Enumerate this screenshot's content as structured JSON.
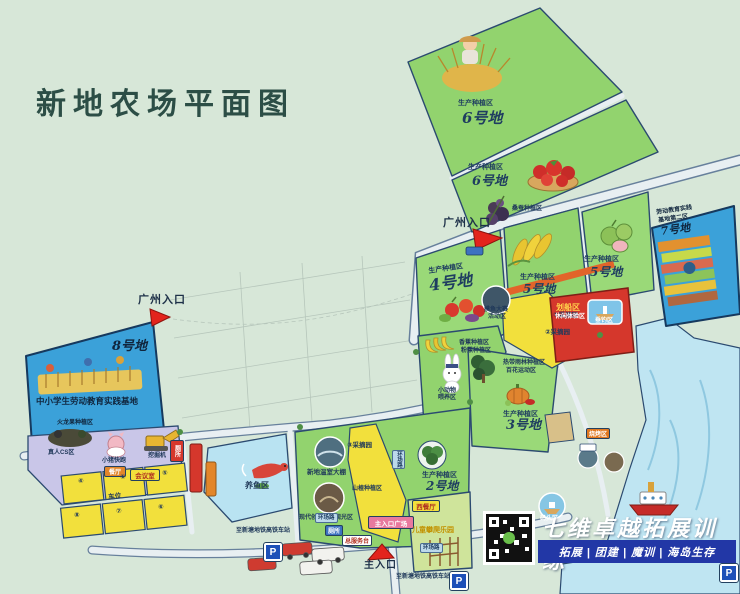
{
  "title": "新地农场平面图",
  "entrances": {
    "guangzhou_top": "广州入口",
    "guangzhou_left": "广州入口",
    "main": "主入口",
    "main_plaza": "主入口广场"
  },
  "plots": {
    "p6a": {
      "zone": "生产种植区",
      "num": "6号地"
    },
    "p6b": {
      "zone": "生产种植区",
      "num": "6号地"
    },
    "p5corn": {
      "zone": "生产种植区",
      "num": "5号地"
    },
    "p5guava": {
      "zone": "生产种植区",
      "num": "5号地"
    },
    "p4": {
      "zone": "生产种植区",
      "num": "4号地"
    },
    "p3": {
      "zone": "生产种植区",
      "num": "3号地"
    },
    "p2": {
      "zone": "生产种植区",
      "num": "2号地"
    },
    "p7": {
      "line1": "劳动教育实践",
      "line2": "基地第二区",
      "num": "7号地"
    },
    "p8": {
      "num": "8号地",
      "name": "中小学生劳动教育实践基地",
      "sub": "火龙果种植区"
    }
  },
  "areas": {
    "mulberry": "桑蚕种植区",
    "banana": "香蕉种植区",
    "banana2": "粉蕉种植区",
    "rabbit1": "小动物",
    "rabbit2": "喂养区",
    "rainforest": "热带雨林种植区",
    "flower": "百花运动区",
    "moyu1": "摸鱼大赛",
    "moyu2": "活动区",
    "boat": "划船区",
    "leisure": "休闲体验区",
    "fishing": "垂钓区",
    "pond": "养鱼区",
    "greenhouse": "新地温室大棚",
    "modern": "现代创意农业观光区",
    "picking1": "①采摘园",
    "picking2": "②采摘园",
    "picking3": "③采摘园",
    "hawthorn": "山楂种植区",
    "cs": "真人CS区",
    "pig": "小猪快跑",
    "digger": "挖掘机",
    "restaurant": "餐厅",
    "meeting": "会议室",
    "western": "西餐厅",
    "climb": "儿童攀爬乐园",
    "dock": "码头区",
    "bbq": "烧烤区"
  },
  "facilities": {
    "toilet": "厕所",
    "service": "总服务台",
    "ring_road": "环场路"
  },
  "parking": {
    "cells": [
      "④",
      "①",
      "⑤",
      "⑧",
      "⑦",
      "⑥"
    ],
    "label": "车位",
    "symbol": "P"
  },
  "transport": {
    "station": "至新塘地铁高铁车站"
  },
  "watermark": {
    "brand": "七维卓越拓展训练",
    "services": "拓展 | 团建 | 魔训 | 海岛生存"
  }
}
